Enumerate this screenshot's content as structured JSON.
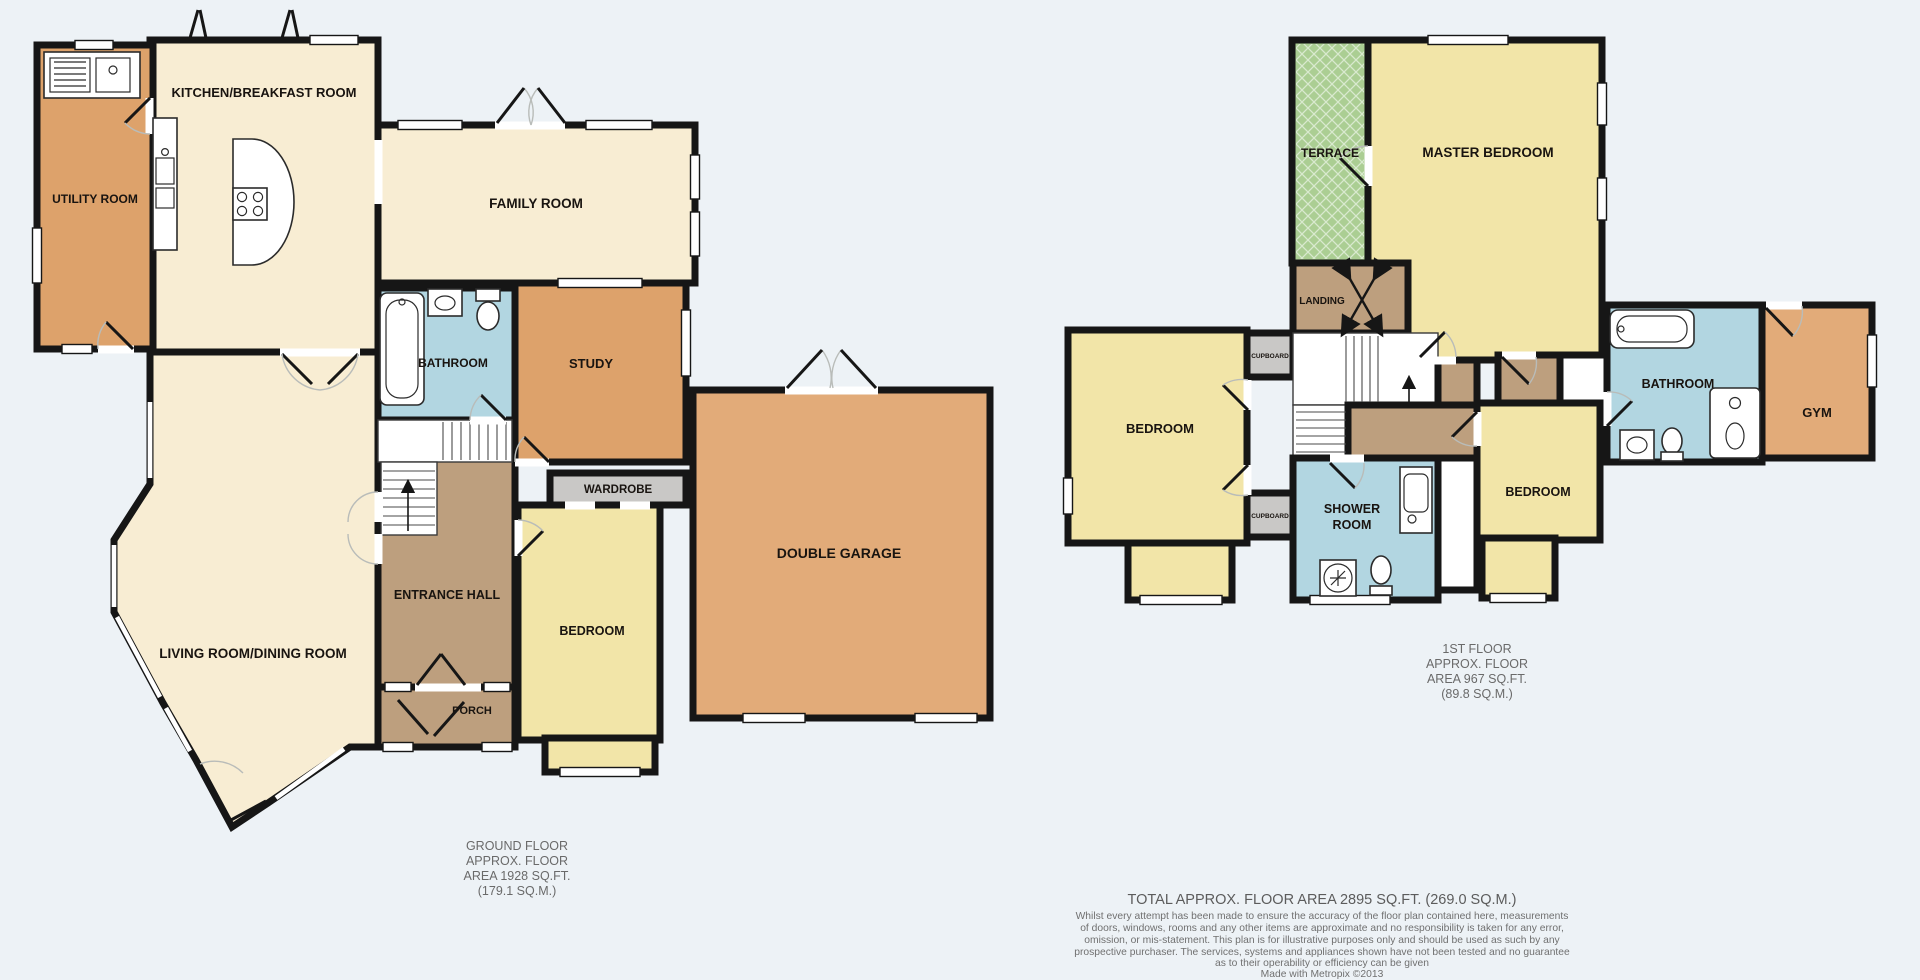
{
  "page": {
    "background": "#edf2f6"
  },
  "palette": {
    "wall": "#161616",
    "cream": "#f8edd3",
    "orange": "#dda26b",
    "garage_orange": "#e2ab79",
    "yellow": "#f2e5a8",
    "blue": "#b2d6e1",
    "brown": "#bd9f7e",
    "cupboard_gray": "#c9c8c6",
    "terrace_green": "#abce93",
    "fixture_white": "#ffffff"
  },
  "icons": {
    "bath": "bath-icon",
    "toilet": "toilet-icon",
    "sink": "sink-icon",
    "shower": "shower-icon",
    "hob": "hob-icon",
    "stairs": "stairs-up-arrow-icon"
  },
  "ground_floor": {
    "rooms": {
      "kitchen": "KITCHEN/BREAKFAST ROOM",
      "utility": "UTILITY ROOM",
      "family": "FAMILY ROOM",
      "bathroom": "BATHROOM",
      "study": "STUDY",
      "wardrobe": "WARDROBE",
      "entrance_hall": "ENTRANCE HALL",
      "bedroom": "BEDROOM",
      "porch": "PORCH",
      "living_dining": "LIVING ROOM/DINING ROOM",
      "garage": "DOUBLE GARAGE"
    },
    "caption": [
      "GROUND FLOOR",
      "APPROX. FLOOR",
      "AREA 1928 SQ.FT.",
      "(179.1 SQ.M.)"
    ]
  },
  "first_floor": {
    "rooms": {
      "terrace": "TERRACE",
      "master_bedroom": "MASTER BEDROOM",
      "landing": "LANDING",
      "bedroom_left": "BEDROOM",
      "cupboard_top": "CUPBOARD",
      "cupboard_bottom": "CUPBOARD",
      "shower_room": [
        "SHOWER",
        "ROOM"
      ],
      "bedroom_middle": "BEDROOM",
      "bathroom": "BATHROOM",
      "gym": "GYM"
    },
    "caption": [
      "1ST FLOOR",
      "APPROX. FLOOR",
      "AREA 967 SQ.FT.",
      "(89.8 SQ.M.)"
    ]
  },
  "footer": {
    "total": "TOTAL APPROX. FLOOR AREA 2895 SQ.FT. (269.0 SQ.M.)",
    "disclaimer": [
      "Whilst every attempt has been made to ensure the accuracy of the floor plan contained here, measurements",
      "of doors, windows, rooms and any other items are approximate and no responsibility is taken for any error,",
      "omission, or mis-statement. This plan is for illustrative purposes only and should be used as such by any",
      "prospective purchaser. The services, systems and appliances shown have not been tested and no guarantee",
      "as to their operability or efficiency can be given"
    ],
    "credit": "Made with Metropix ©2013"
  }
}
